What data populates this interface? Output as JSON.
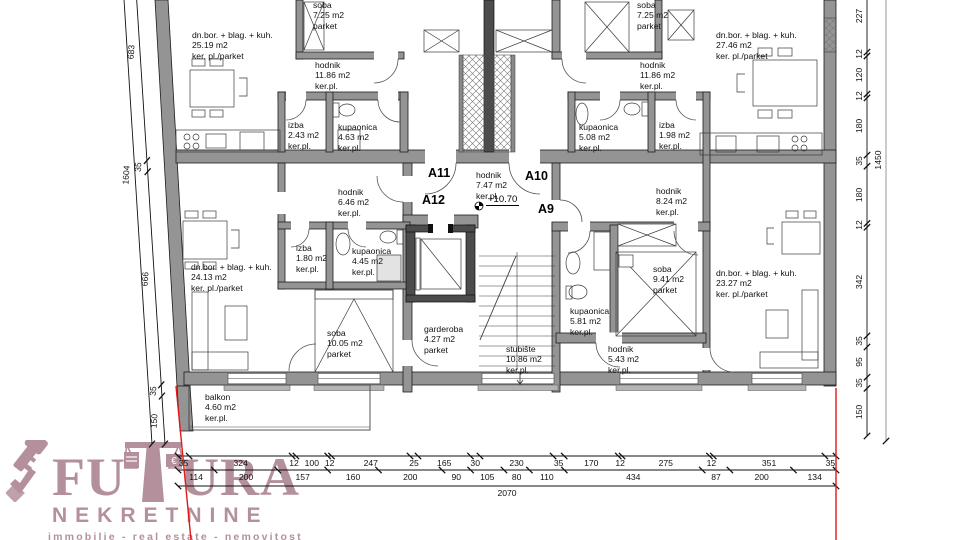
{
  "apartments": {
    "a11": "A11",
    "a12": "A12",
    "a10": "A10",
    "a9": "A9"
  },
  "misc": {
    "elevation": "+10.70"
  },
  "rooms": {
    "tl_dnbor": {
      "name": "dn.bor. + blag. + kuh.",
      "area": "25.19 m2",
      "floor": "ker. pl./parket"
    },
    "tl_soba": {
      "name": "soba",
      "area": "7.25 m2",
      "floor": "parket"
    },
    "tl_hodnik": {
      "name": "hodnik",
      "area": "11.86 m2",
      "floor": "ker.pl."
    },
    "tl_izba": {
      "name": "izba",
      "area": "2.43 m2",
      "floor": "ker.pl."
    },
    "tl_kup": {
      "name": "kupaonica",
      "area": "4.63 m2",
      "floor": "ker.pl."
    },
    "tr_soba": {
      "name": "soba",
      "area": "7.25 m2",
      "floor": "parket"
    },
    "tr_dnbor": {
      "name": "dn.bor. + blag. + kuh.",
      "area": "27.46 m2",
      "floor": "ker. pl./parket"
    },
    "tr_hodnik": {
      "name": "hodnik",
      "area": "11.86 m2",
      "floor": "ker.pl."
    },
    "tr_kup": {
      "name": "kupaonica",
      "area": "5.08 m2",
      "floor": "ker.pl."
    },
    "tr_izba": {
      "name": "izba",
      "area": "1.98 m2",
      "floor": "ker.pl."
    },
    "corridor": {
      "name": "hodnik",
      "area": "7.47 m2",
      "floor": "ker.pl."
    },
    "mid_hodnik": {
      "name": "hodnik",
      "area": "8.24 m2",
      "floor": "ker.pl."
    },
    "bl_hodnik": {
      "name": "hodnik",
      "area": "6.46 m2",
      "floor": "ker.pl."
    },
    "bl_izba": {
      "name": "izba",
      "area": "1.80 m2",
      "floor": "ker.pl."
    },
    "bl_kup": {
      "name": "kupaonica",
      "area": "4.45 m2",
      "floor": "ker.pl."
    },
    "bl_dnbor": {
      "name": "dn.bor. + blag. + kuh.",
      "area": "24.13 m2",
      "floor": "ker. pl./parket"
    },
    "bl_soba": {
      "name": "soba",
      "area": "10.05 m2",
      "floor": "parket"
    },
    "garderoba": {
      "name": "garderoba",
      "area": "4.27 m2",
      "floor": "parket"
    },
    "stubiste": {
      "name": "stubište",
      "area": "10.86 m2",
      "floor": "ker.pl."
    },
    "br_kup": {
      "name": "kupaonica",
      "area": "5.81 m2",
      "floor": "ker.pl."
    },
    "br_soba": {
      "name": "soba",
      "area": "9.41 m2",
      "floor": "parket"
    },
    "br_hodnik": {
      "name": "hodnik",
      "area": "5.43 m2",
      "floor": "ker.pl."
    },
    "br_dnbor": {
      "name": "dn.bor. + blag. + kuh.",
      "area": "23.27 m2",
      "floor": "ker. pl./parket"
    },
    "balkon": {
      "name": "balkon",
      "area": "4.60 m2",
      "floor": "ker.pl."
    }
  },
  "dimensions": {
    "bottom_row1": [
      35,
      324,
      12,
      100,
      12,
      247,
      25,
      165,
      30,
      230,
      35,
      170,
      12,
      275,
      12,
      351,
      35
    ],
    "bottom_row2": [
      114,
      200,
      157,
      160,
      200,
      90,
      105,
      80,
      110,
      434,
      87,
      200,
      134
    ],
    "bottom_total": [
      2070
    ],
    "right_col": [
      227,
      12,
      120,
      12,
      180,
      35,
      180,
      12,
      342,
      35,
      95,
      35,
      150
    ],
    "right_total": [
      1450
    ],
    "left_col": [
      683,
      35,
      666,
      35,
      150
    ],
    "left_total": [
      1604
    ]
  },
  "logo": {
    "word_left": "FU",
    "word_right": "URA",
    "line2": "NEKRETNINE",
    "tagline": "immobilie - real estate - nemovitost",
    "accent_color": "#b3909c"
  },
  "colors": {
    "wall_gray": "#949494",
    "boundary_red": "#e01818",
    "line_black": "#1c1c1c"
  }
}
